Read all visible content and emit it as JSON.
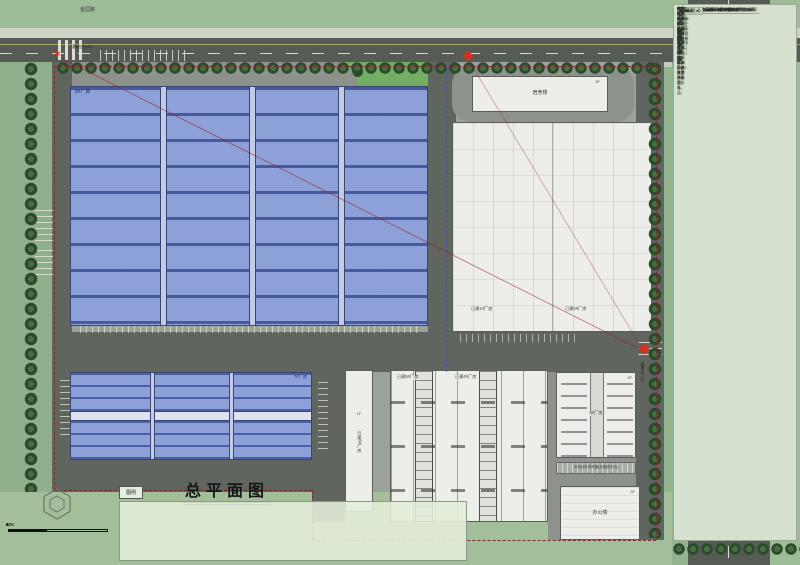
{
  "title": "总平面图",
  "colors": {
    "roof_blue": "#8da0d8",
    "roof_blue_line": "#2f448c",
    "road_gray": "#60655f",
    "grass_green": "#8fb08a",
    "field_green": "#a2bf99",
    "paper_green": "#d6e2cf",
    "accent_red": "#d43322",
    "tree_green": "#2c4a2c"
  },
  "plan": {
    "road_name_top": "金园路",
    "labels": {
      "entrance_top": "基地出入口",
      "entrance_right": "基地出入口",
      "b8": "8#厂房",
      "b7": "7#厂房",
      "dorm": "宿舍楼",
      "dorm_tag": "5F",
      "f1": "已建1#厂房",
      "f2": "已建2#厂房",
      "f5": "已建5#厂房",
      "f4": "已建4#厂房",
      "f6": "已建6#厂房",
      "f6_tag": "1F",
      "f3": "3#厂房",
      "f3_tag": "3F",
      "office": "办公楼",
      "office_tag": "3F",
      "shed": "非机动车停车棚(充电桩车位)"
    }
  },
  "legend": {
    "header": "图例",
    "items": [
      {
        "icon": "road",
        "label": "道路"
      },
      {
        "icon": "indoor-level",
        "label": "室内标高"
      },
      {
        "icon": "car-parking",
        "label": "地面小车停车车位"
      },
      {
        "icon": "phase2-line",
        "label": "二期用地红线"
      },
      {
        "icon": "outdoor-level",
        "label": "室外标高"
      },
      {
        "icon": "charging-parking",
        "label": "充电桩停车位"
      },
      {
        "icon": "phase1-line",
        "label": "一期用地红线"
      },
      {
        "icon": "survey-coord",
        "label": "测量坐标"
      },
      {
        "icon": "pavement",
        "label": "场地铺砌"
      }
    ]
  },
  "scalebar": {
    "labels": [
      "0",
      "10",
      "20",
      "30",
      "40",
      "60M"
    ]
  },
  "sidebar": {
    "sections": [
      {
        "type": "kv",
        "title": "总经济技术指标",
        "lines": [
          "规划用地面积：82864.0平方米",
          "规划建筑面积：54035.2平方米",
          "规划建设面积(计容面积)：110338.9平方米",
          "建筑基底面积：48340.5平方米",
          "建筑密度：58.3%",
          "容积率：1.33",
          "机动车停车位：139辆（其中充电桩车位54辆）",
          "非机动车停车位面积：823.4平方米"
        ]
      },
      {
        "type": "table",
        "title": "建筑明细表",
        "headers": [
          "建筑名称",
          "基底面积(㎡)",
          "建筑面积(㎡)",
          "计容面积(㎡)"
        ],
        "rows": [
          [
            "已建厂房",
            "11086.2",
            "11086.2",
            "22176.4"
          ],
          [
            "已建办公楼",
            "666.9",
            "1942.4",
            "1942.4"
          ],
          [
            "已建宿舍楼",
            "1932.3",
            "5946.6",
            "5946.6"
          ],
          [
            "已建辅房栋(门卫)",
            "618.0",
            "618.0",
            "618.0"
          ],
          [
            "3、4、5#及机动车库厂房",
            "6391.4",
            "6391.4",
            "12762.8"
          ],
          [
            "7#厂房",
            "5395.4",
            "5395.4",
            "16718.6"
          ],
          [
            "8#厂房",
            "21465.5",
            "21463.5",
            "46956.4"
          ],
          [
            "垃圾用房",
            "113.0",
            "113.3",
            "113.3"
          ],
          [
            "3#厂房",
            "1677.1",
            "1677.1",
            "3354.2"
          ],
          [
            "合计",
            "48340.5",
            "54035.2",
            "110338.9"
          ]
        ]
      },
      {
        "type": "kv",
        "title": "一期经济技术指标",
        "lines": [
          "规划用地面积：46463.5平方米",
          "规划建筑面积：27062.9平方米",
          "规划建设面积(计容面积)：46550.6平方米",
          "建筑基底面积：21366.6平方米",
          "建筑密度：46.0%",
          "容积率：1.00",
          "机动车停车位：63辆（其中充电桩车位23辆）",
          "非机动车停车位面积：463.4平方米"
        ]
      },
      {
        "type": "table",
        "title": "建筑明细表",
        "headers": [
          "建筑名称",
          "基底面积(㎡)",
          "建筑面积(㎡)",
          "计容面积(㎡)"
        ],
        "rows": [
          [
            "已建厂房",
            "11086.19",
            "11086.19",
            "22176.38"
          ],
          [
            "已建办公楼",
            "666.90",
            "1942.38",
            "1942.38"
          ],
          [
            "已建宿舍楼",
            "1932.30",
            "5946.60",
            "5946.60"
          ],
          [
            "已建辅房栋(门卫)",
            "618.00",
            "618.00",
            "618.00"
          ],
          [
            "3、4、5#及机动车库厂房",
            "6391.40",
            "6391.41",
            "12762.80"
          ],
          [
            "3#厂房",
            "1677.11",
            "1677.11",
            "3354.22"
          ],
          [
            "合计",
            "21366.61",
            "27062.99",
            "46550.60"
          ]
        ]
      },
      {
        "type": "kv",
        "title": "二期经济技术指标",
        "lines": [
          "规划用地面积：36400.5平方米",
          "规划建筑面积：26972.2平方米",
          "规划建设面积(计容面积)：63788.3平方米",
          "建筑基底面积：26973.9平方米",
          "建筑密度：74.1%",
          "容积率：1.75",
          "机动车停车位：76辆（其中充电桩车位31辆）",
          "非机动车停车位面积：360.0平方米"
        ]
      },
      {
        "type": "table",
        "title": "建筑明细表",
        "headers": [
          "建筑名称",
          "基底面积(㎡)",
          "建筑面积(㎡)",
          "计容面积(㎡)"
        ],
        "rows": [
          [
            "7#厂房",
            "5395.4",
            "5395.4",
            "16718.6"
          ],
          [
            "8#厂房",
            "21465.5",
            "21463.5",
            "46956.4"
          ],
          [
            "垃圾用房",
            "113.0",
            "113.3",
            "113.3"
          ],
          [
            "合计",
            "26973.9",
            "26972.2",
            "63788.3"
          ]
        ]
      },
      {
        "type": "notes",
        "title": "",
        "lines": [
          "1.本图所注尺寸除标高以米计外，其余均以毫米为单位。",
          "2.本工程±0.000相当于绝对标高，详见各单体设计说明。",
          "3.机动车停车位：",
          "  按1.0车位/100平方米标准计算，地面停车位共139辆，",
          "  其中一期63辆、二期76辆，充电桩车位54辆，沿道路两侧布置。",
          "4.非机动车停车位：",
          "  按0.6车位/100平方米计算，设非机动车停车棚，面积823.4平方米，",
          "  均设置充电设施，满足使用要求。",
          "5.生活垃圾收集点结合垃圾用房设置，按规范配置分类收集及消毒设备。",
          "6.基地内道路宽6m，转弯半径满足消防要求，沿8#厂房设置环形消防车道，",
          "  并按规范设置消防登高操作场地。"
        ]
      }
    ]
  }
}
